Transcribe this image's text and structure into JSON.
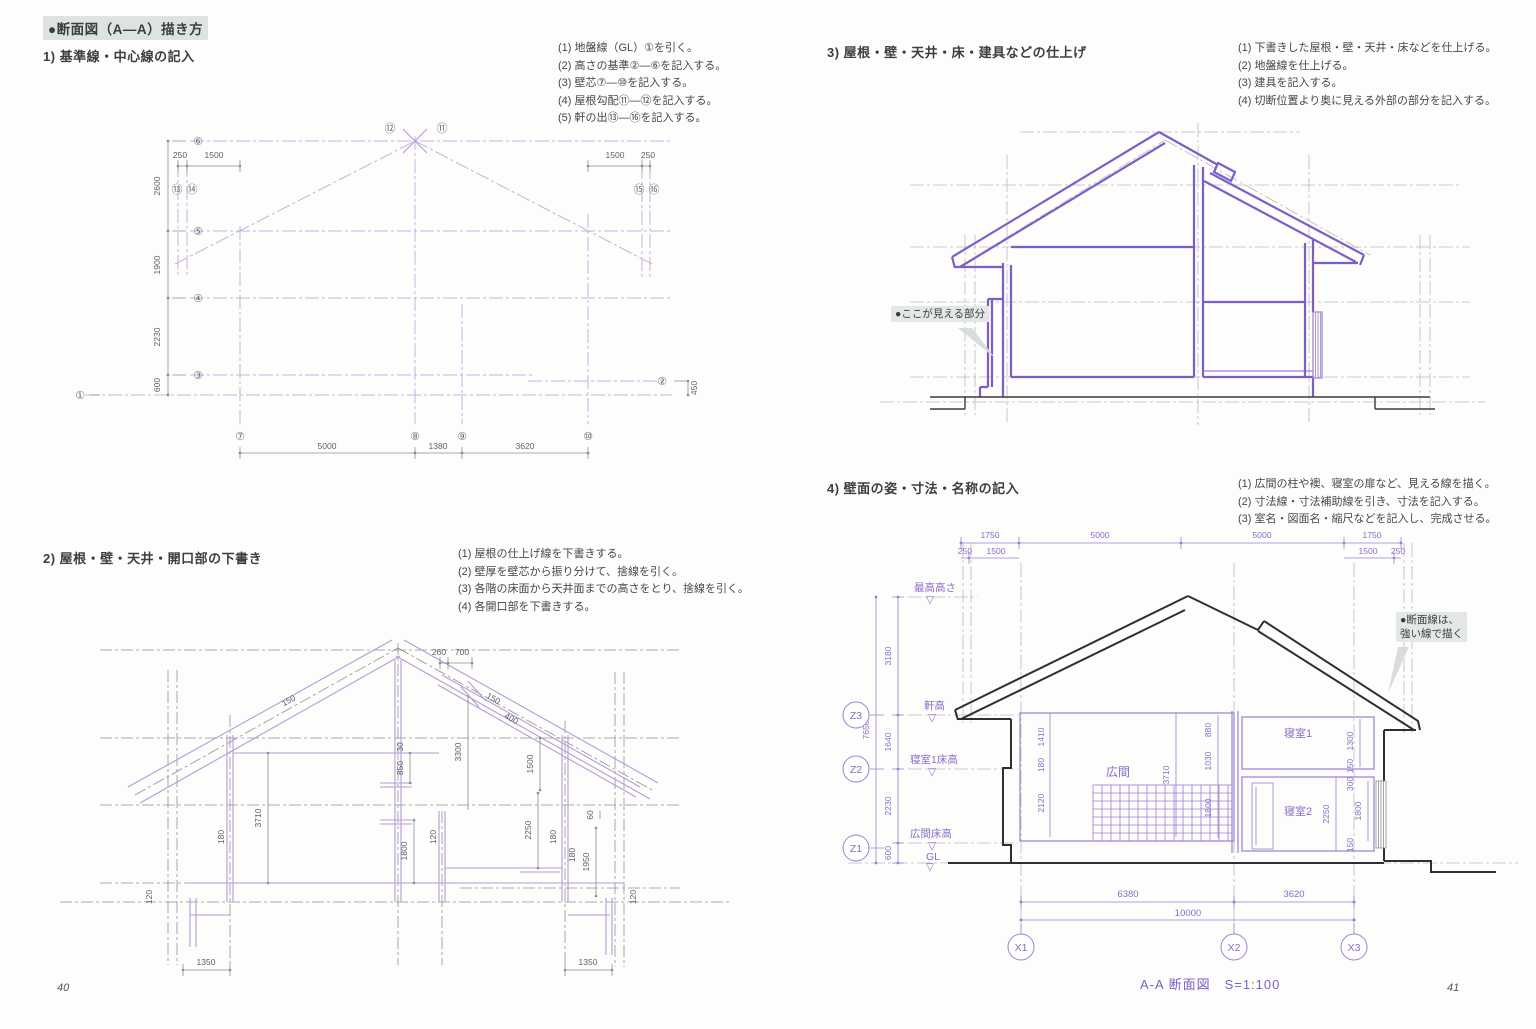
{
  "page": {
    "title": "●断面図（A—A）描き方",
    "page_no_left": "40",
    "page_no_right": "41"
  },
  "steps": {
    "s1": {
      "heading": "1) 基準線・中心線の記入",
      "items": [
        "(1) 地盤線（GL）①を引く。",
        "(2) 高さの基準②—⑥を記入する。",
        "(3) 壁芯⑦—⑩を記入する。",
        "(4) 屋根勾配⑪—⑫を記入する。",
        "(5) 軒の出⑬—⑯を記入する。"
      ]
    },
    "s2": {
      "heading": "2) 屋根・壁・天井・開口部の下書き",
      "items": [
        "(1) 屋根の仕上げ線を下書きする。",
        "(2) 壁厚を壁芯から振り分けて、捨線を引く。",
        "(3) 各階の床面から天井面までの高さをとり、捨線を引く。",
        "(4) 各開口部を下書きする。"
      ]
    },
    "s3": {
      "heading": "3) 屋根・壁・天井・床・建具などの仕上げ",
      "items": [
        "(1) 下書きした屋根・壁・天井・床などを仕上げる。",
        "(2) 地盤線を仕上げる。",
        "(3) 建具を記入する。",
        "(4) 切断位置より奥に見える外部の部分を記入する。"
      ]
    },
    "s4": {
      "heading": "4) 壁面の姿・寸法・名称の記入",
      "items": [
        "(1) 広間の柱や襖、寝室の扉など、見える線を描く。",
        "(2) 寸法線・寸法補助線を引き、寸法を記入する。",
        "(3) 室名・図面名・縮尺などを記入し、完成させる。"
      ]
    }
  },
  "callouts": {
    "visible_part": "●ここが見える部分",
    "section_line_1": "●断面線は、",
    "section_line_2": "強い線で描く"
  },
  "d1": {
    "levels": {
      "l6": "⑥",
      "l5": "⑤",
      "l4": "④",
      "l3": "③",
      "l1": "①",
      "l2": "②"
    },
    "vdims": {
      "d26": "2600",
      "d19": "1900",
      "d223": "2230",
      "d06": "600",
      "d45": "450"
    },
    "apex": {
      "left": "⑫",
      "right": "⑪"
    },
    "eaveL": {
      "c1": "⑬",
      "c2": "⑭",
      "d1": "250",
      "d2": "1500"
    },
    "eaveR": {
      "c1": "⑮",
      "c2": "⑯",
      "d1": "1500",
      "d2": "250"
    },
    "bottom": {
      "c7": "⑦",
      "c8": "⑧",
      "c9": "⑨",
      "c10": "⑩",
      "d1": "5000",
      "d2": "1380",
      "d3": "3620"
    }
  },
  "d2": {
    "dims": {
      "top1": "260",
      "top2": "700",
      "slopeL": "150",
      "slopeR1": "150",
      "slopeR2": "400",
      "h3710": "3710",
      "h3300": "3300",
      "h850": "850",
      "h30": "30",
      "h1800": "1800",
      "h1500": "1500",
      "h2250": "2250",
      "h1950": "1950",
      "h60": "60",
      "w180L": "180",
      "w120": "120",
      "w180R": "180",
      "w180R2": "180",
      "b1350L": "1350",
      "b1350R": "1350",
      "e120L": "120",
      "e120R": "120"
    }
  },
  "d4": {
    "top": {
      "a": "1750",
      "b": "5000",
      "c": "5000",
      "d": "1750",
      "sl1": "250",
      "sl2": "1500",
      "sr1": "1500",
      "sr2": "250"
    },
    "left": {
      "total": "7650",
      "d1": "3180",
      "d2": "1640",
      "d3": "2230",
      "d4": "600"
    },
    "levels": {
      "max": "最高高さ",
      "eave": "軒高",
      "bed1": "寝室1床高",
      "hall": "広間床高",
      "gl": "GL"
    },
    "gridZ": {
      "z3": "Z3",
      "z2": "Z2",
      "z1": "Z1"
    },
    "rooms": {
      "hall": "広間",
      "bed1": "寝室1",
      "bed2": "寝室2"
    },
    "inner": {
      "a": "1410",
      "b": "180",
      "c": "2120",
      "d": "3710",
      "e": "880",
      "f": "1030",
      "g": "1800",
      "h": "1300",
      "i": "150",
      "j": "300",
      "k": "2250",
      "l": "1800",
      "m": "150"
    },
    "bottom": {
      "d1": "6380",
      "d2": "3620",
      "total": "10000"
    },
    "gridX": {
      "x1": "X1",
      "x2": "X2",
      "x3": "X3"
    },
    "caption": "A-A 断面図　S=1:100"
  }
}
